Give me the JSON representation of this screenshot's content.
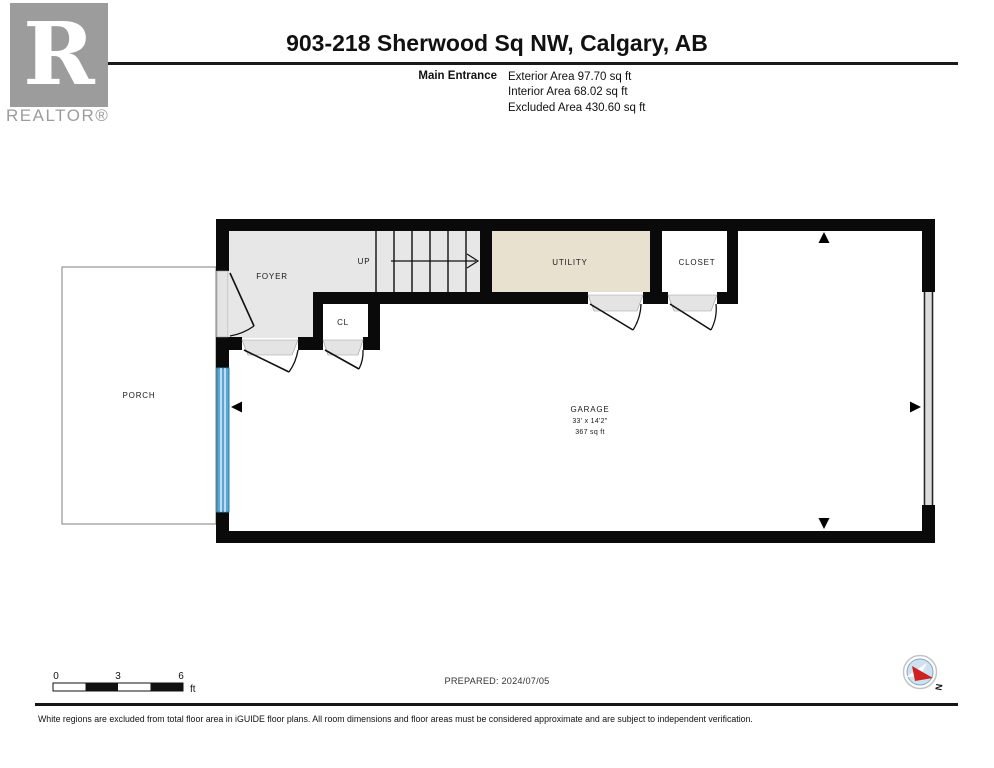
{
  "header": {
    "title": "903-218 Sherwood Sq NW, Calgary, AB",
    "entrance_label": "Main Entrance",
    "areas": [
      "Exterior Area 97.70 sq ft",
      "Interior Area 68.02 sq ft",
      "Excluded Area 430.60 sq ft"
    ]
  },
  "logo": {
    "letter": "R",
    "wordmark": "REALTOR®"
  },
  "plan": {
    "labels": {
      "foyer": "FOYER",
      "up": "UP",
      "utility": "UTILITY",
      "closet": "CLOSET",
      "cl": "CL",
      "porch": "PORCH",
      "garage_name": "GARAGE",
      "garage_dimensions": "33' x 14'2\"",
      "garage_area": "367 sq ft"
    },
    "colors": {
      "wall": "#0a0a0a",
      "foyer_fill": "#e7e7e7",
      "utility_fill": "#e9e1cf",
      "sill_fill": "#e4e4e4",
      "window_blue": "#5aa7d4",
      "window_blue_dark": "#2e7cab",
      "compass_blue": "#cfe1ef",
      "compass_red": "#cc2222",
      "logo_gray": "#9c9c9c"
    }
  },
  "footer": {
    "scale_ticks": [
      "0",
      "3",
      "6"
    ],
    "scale_unit": "ft",
    "prepared": "PREPARED: 2024/07/05",
    "compass_north": "N",
    "disclaimer": "White regions are excluded from total floor area in iGUIDE floor plans. All room dimensions and floor areas must be considered approximate and are subject to independent verification."
  }
}
